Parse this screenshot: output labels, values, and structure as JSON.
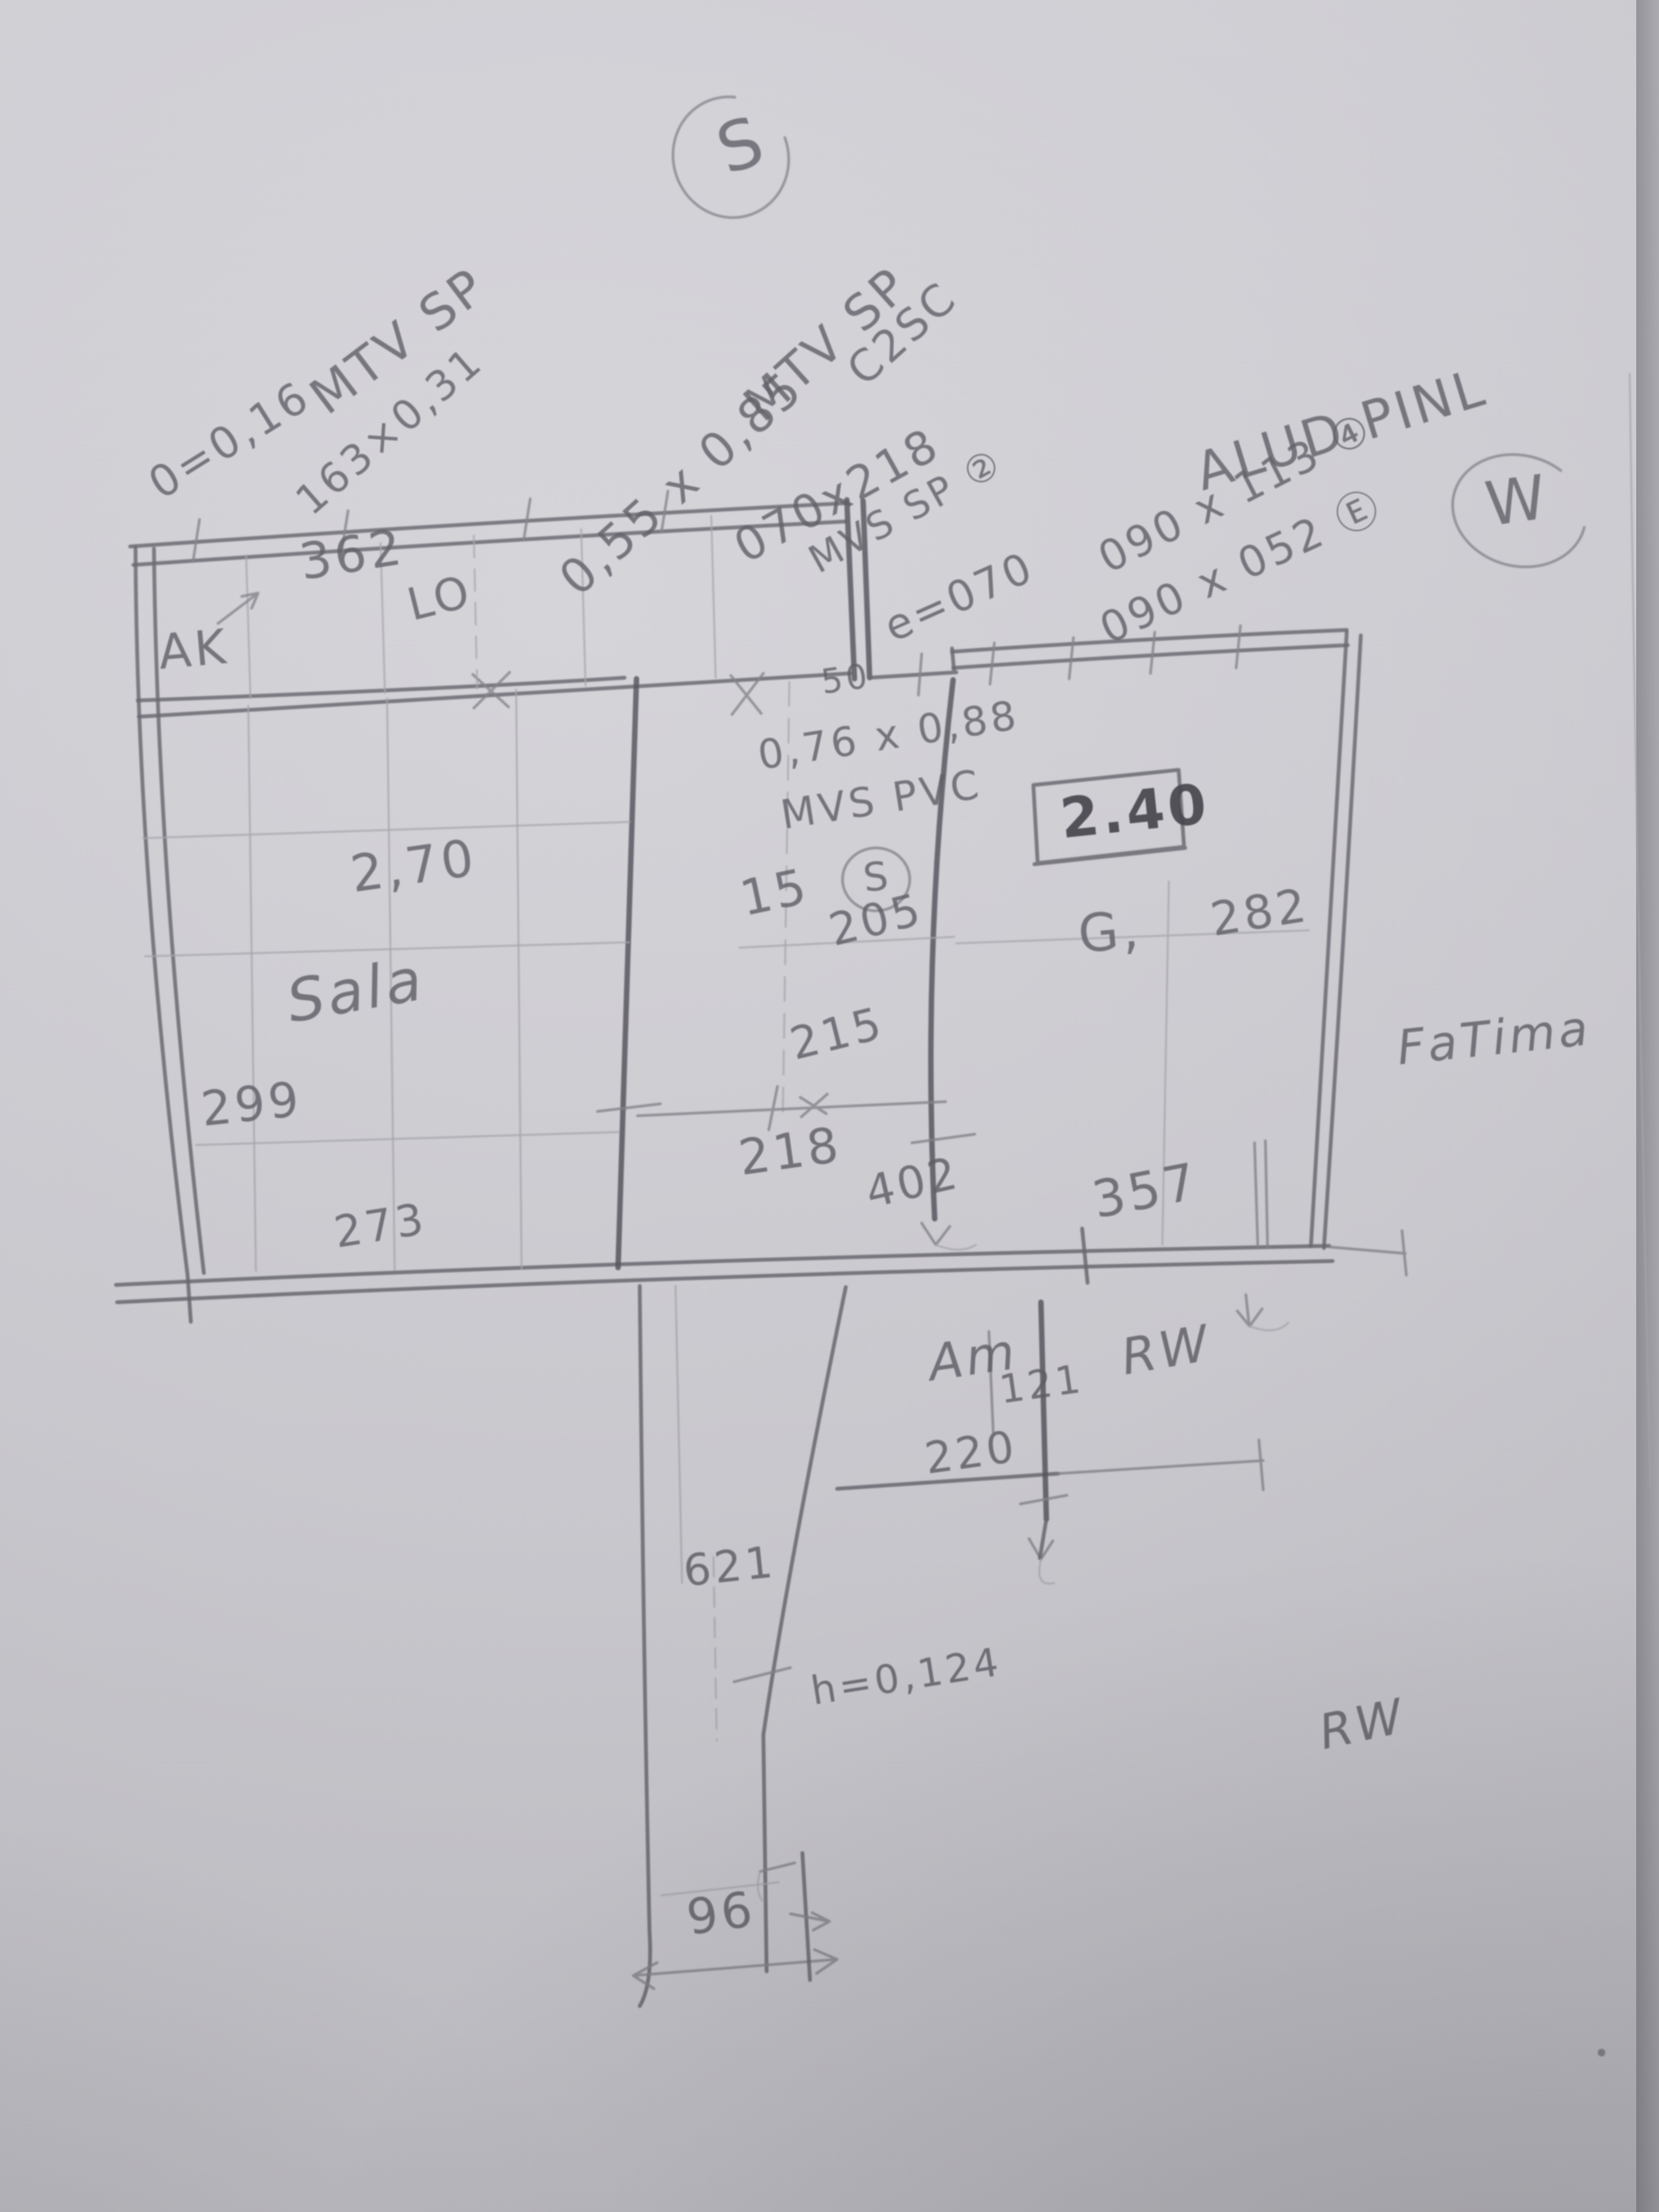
{
  "compass": {
    "south": "S",
    "west": "W"
  },
  "labels": {
    "window1": {
      "title": "MTV SP",
      "dim_a": "0=0,16",
      "dim_b": "163×0,31"
    },
    "window2": {
      "title": "MTV SP",
      "dim": "0,55 x 0,85",
      "tag": "C2SC"
    },
    "door": {
      "dim": "070x218",
      "label": "MVS SP ②",
      "extra": "e=070"
    },
    "alu": {
      "title": "ALUD PINL",
      "dim_a": "090 x 113 ④",
      "dim_b": "090 x 052 Ⓔ"
    },
    "pvc": {
      "dim": "0,76 x 0,88",
      "label": "MVS PVC",
      "tag": "S"
    },
    "rooms": {
      "sala": "Sala",
      "am": "Am"
    },
    "names": {
      "owner": "FaTima",
      "rw_upper": "RW",
      "rw_lower": "RW",
      "ak": "AK",
      "lo": "LO",
      "g": "G,"
    },
    "notes": {
      "height_box": "2.40",
      "low_note": "h=0,124",
      "fifty": "50"
    }
  },
  "dimensions": {
    "top": "362",
    "sala_w": "2,70",
    "sala_h": "299",
    "sala_b": "273",
    "mid_gap": "15",
    "mid_a": "205",
    "mid_b": "215",
    "mid_c": "218",
    "mid_d": "402",
    "right_w": "282",
    "right_b": "357",
    "am_h": "121",
    "am_w": "220",
    "corr_h": "621",
    "corr_w": "96"
  }
}
